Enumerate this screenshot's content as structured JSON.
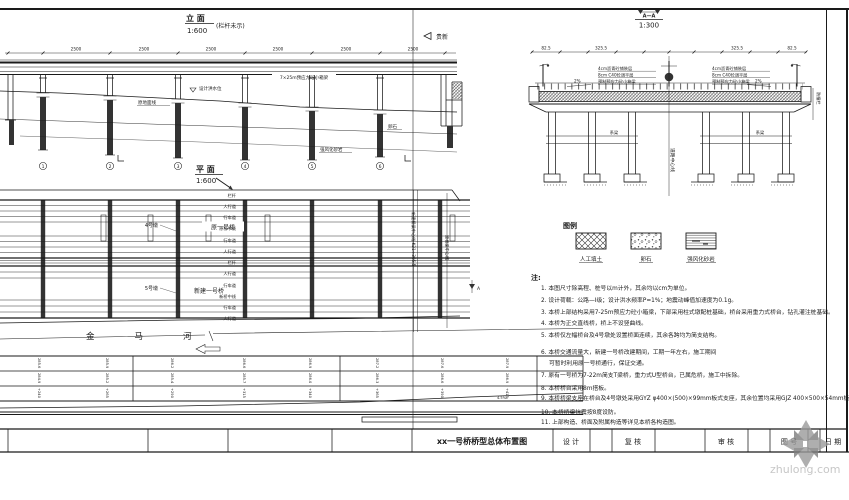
{
  "page": {
    "watermark_text": "zhulong.com"
  },
  "elevation": {
    "title": "立 面",
    "scale": "1:600",
    "subtitle": "(栏杆未示)",
    "direction": "贵新",
    "girder_label": "7×25m预应力砼小箱梁",
    "span_dims": [
      "2500",
      "2500",
      "2500",
      "2500",
      "2500",
      "2500"
    ],
    "pier_nos": [
      "1",
      "2",
      "3",
      "4",
      "5",
      "6"
    ],
    "ann_flood": "设计洪水位",
    "ann_ground": "原地面线",
    "ann_pebble": "卵石",
    "ann_rock": "强风化砂岩"
  },
  "section": {
    "title": "A—A",
    "scale": "1:300",
    "dims": [
      "82.5",
      "325.5",
      "325.5",
      "82.5"
    ],
    "layers": [
      "4cm沥青砼铺装层",
      "8cm C40砼调平层",
      "预制预应力砼小箱梁"
    ],
    "slope": "2%",
    "centerline": "道路中心线",
    "barrier": "防撞栏",
    "tie_beam": "系梁"
  },
  "plan": {
    "title": "平 面",
    "scale": "1:600",
    "old_bridge": "原一号桥",
    "new_bridge": "新建一号桥",
    "river": "金马河",
    "pier_note1": "4号墩",
    "pier_note2": "5号墩",
    "centerline_label": "新建桥梁中心线 K21+305.5",
    "old_centerline_label": "原桥梁中心线",
    "cut_mark": "A",
    "edge": [
      "栏杆",
      "人行道",
      "行车道",
      "原桥中线",
      "行车道",
      "人行道",
      "栏杆",
      "人行道",
      "行车道",
      "新桥中线",
      "行车道",
      "人行道"
    ]
  },
  "profile": {
    "r1": [
      "285.6",
      "285.9",
      "286.2",
      "286.6",
      "286.9",
      "287.2",
      "287.6",
      "287.9"
    ],
    "r2": [
      "284.9",
      "285.2",
      "285.4",
      "285.7",
      "286.0",
      "286.3",
      "286.6",
      "286.9"
    ],
    "r3": [
      "+240",
      "+265",
      "+290",
      "+315",
      "+340",
      "+365",
      "+390",
      "+415"
    ],
    "slope_note": "4.5‰"
  },
  "legend": {
    "title": "图例",
    "items": [
      "人工填土",
      "卵石",
      "强风化砂岩"
    ]
  },
  "notes": {
    "title": "注:",
    "lines": [
      "1. 本图尺寸除高程、桩号以m计外，其余均以cm为单位。",
      "2. 设计荷载：公路—Ⅰ级；设计洪水频率P=1%；地震动峰值加速度为0.1g。",
      "3. 本桥上部结构采用7-25m预应力砼小箱梁，下部采用柱式墩配桩基础，桥台采用重力式桥台，钻孔灌注桩基础。",
      "4. 本桥为正交直线桥，桥上不设竖曲线。",
      "5. 本桥仅左幅桥台及4号墩处设置桥面连续，其余各跨均为简支结构。",
      "6. 本桥交通流量大，新建一号桥改建期间，工期一年左右，施工期间",
      "可暂时利用原一号桥通行，保证交通。",
      "7. 原有一号桥为7-22m简支T梁桥，重力式U型桥台，已属危桥，施工中拆除。",
      "8. 本桥桥台采用8m搭板。",
      "9. 本桥桥梁支座在桥台及4号墩处采用GYZ φ400×(500)×99mm板式支座，其余位置均采用GJZ 400×500×54mm板式支座。",
      "10. 本桥桥梁抗震按8度设防。",
      "11. 上部构造、桥面及附属构造等详见本桥各构造图。"
    ]
  },
  "title_block": {
    "drawing_title": "xx一号桥桥型总体布置图",
    "design": "设 计",
    "check": "复 核",
    "review": "审 核",
    "fig_no": "图 号",
    "date": "日 期"
  }
}
